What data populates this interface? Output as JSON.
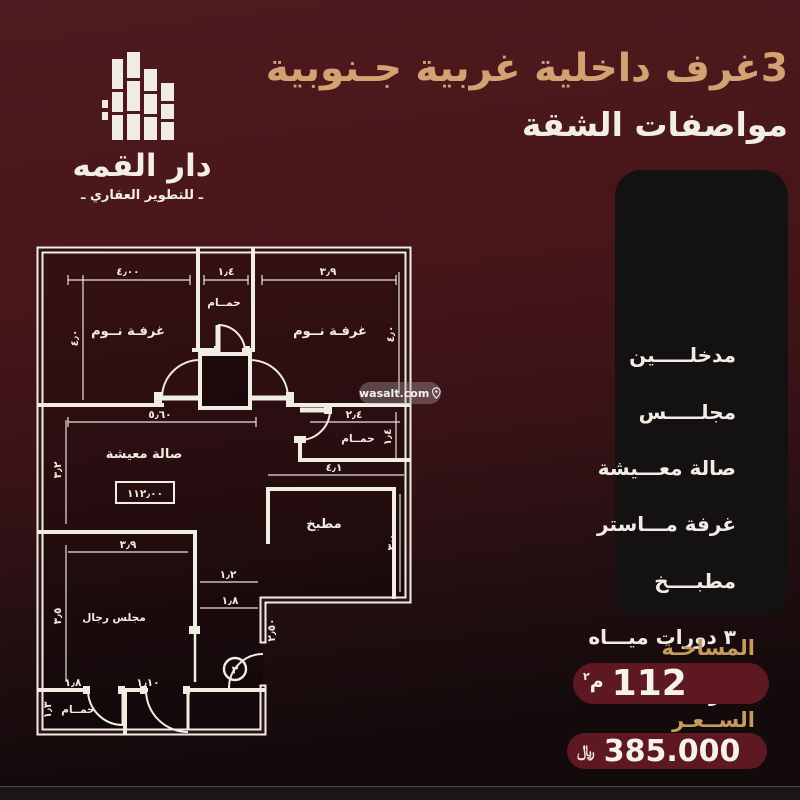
{
  "header": {
    "title_line1": "3غرف داخلية غربية جـنوبية",
    "title_line2": "مواصفات الشقة"
  },
  "logo": {
    "name": "دار القمه",
    "tagline": "ـ للتطوير العقاري ـ",
    "icon": "buildings-skyline-icon"
  },
  "features": {
    "items": [
      "مدخلـــــين",
      "مجلـــــس",
      "صالة معـــيشة",
      "غرفة مـــاستر",
      "مطبــــخ",
      "٣ دورات ميـــاه",
      "خزانات خـــاصة",
      "موقف خـــاص"
    ]
  },
  "summary": {
    "area_label": "المساحـة",
    "area_value": "112",
    "area_unit_letter": "م",
    "area_unit_sup": "٢",
    "price_label": "الســعـر",
    "price_value": "385.000",
    "currency_symbol": "﷼"
  },
  "watermark": {
    "text": "wasalt.com",
    "icon": "location-pin-icon"
  },
  "floor_plan": {
    "area_box": "١١٢٫٠٠",
    "door_number": "٣",
    "rooms": [
      {
        "label": "غرفـة نــوم"
      },
      {
        "label": "حمــام"
      },
      {
        "label": "غرفـة نــوم"
      },
      {
        "label": "صالة معيشة"
      },
      {
        "label": "حمــام"
      },
      {
        "label": "مطبخ"
      },
      {
        "label": "مجلس رجال"
      },
      {
        "label": "حمــام"
      }
    ],
    "dimensions": [
      {
        "t": "٤٫٠٠"
      },
      {
        "t": "١٫٤"
      },
      {
        "t": "٣٫٩"
      },
      {
        "t": "٤٫٠"
      },
      {
        "t": "٤٫٠"
      },
      {
        "t": "٥٫٦٠"
      },
      {
        "t": "٢٫٤"
      },
      {
        "t": "١٫٤"
      },
      {
        "t": "٤٫١"
      },
      {
        "t": "٣٫٢"
      },
      {
        "t": "٣٫٠"
      },
      {
        "t": "٣٫٩"
      },
      {
        "t": "١٫٢"
      },
      {
        "t": "١٫٨"
      },
      {
        "t": "٢٫٥٠"
      },
      {
        "t": "٣٫٥"
      },
      {
        "t": "١٫١٠"
      },
      {
        "t": "١٫٨"
      },
      {
        "t": "١٫٣"
      }
    ]
  },
  "colors": {
    "background_top": "#4e1a1f",
    "background_bottom": "#130a0b",
    "accent_gold": "#d2a272",
    "label_gold": "#c59a5e",
    "panel_bg": "#141112",
    "pill_bg": "#5d1822",
    "text_light": "#f3eee5",
    "plan_line": "#f2ede3"
  }
}
